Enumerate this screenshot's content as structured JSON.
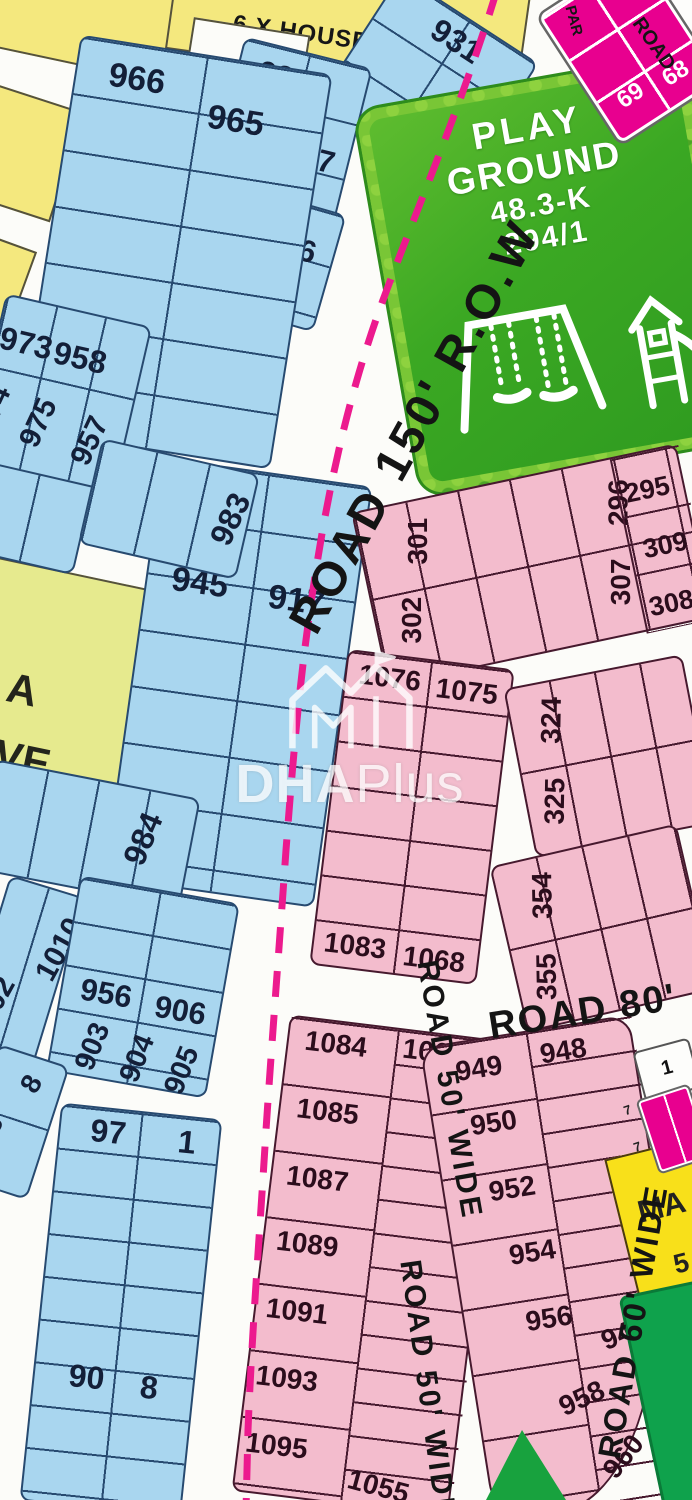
{
  "roads": {
    "row150": "ROAD 150' R.O.W",
    "r80": "ROAD 80'",
    "r50": "ROAD 50' WIDE",
    "r60": "ROAD 60' WIDE",
    "corner": "ROAD",
    "park": "PAR"
  },
  "areas": {
    "house": "6 X HOUSE",
    "pg1": "PLAY",
    "pg2": "GROUND",
    "pg3": "48.3-K",
    "pg4": "294/1",
    "res1": "A",
    "res2": "RVE",
    "ma": "MA",
    "ma5": "5"
  },
  "watermark": {
    "bold": "DHA",
    "light": "Plus"
  },
  "plots": {
    "blue_top": [
      "931",
      "932",
      "934",
      "927",
      "935",
      "926"
    ],
    "blue_left": [
      "966",
      "965"
    ],
    "blue_973": [
      "973",
      "958",
      "974",
      "975",
      "957"
    ],
    "blue_983": [
      "983"
    ],
    "blue_945": [
      "945",
      "917"
    ],
    "blue_984": [
      "984"
    ],
    "blue_1010": [
      "1010",
      "902"
    ],
    "blue_956": [
      "956",
      "906",
      "903",
      "904",
      "905"
    ],
    "blue_97": [
      "97",
      "1",
      "90",
      "8"
    ],
    "blue_98": [
      "8",
      "98"
    ],
    "pink_301": [
      "301",
      "302",
      "296",
      "307",
      "295",
      "309",
      "308"
    ],
    "pink_1076": [
      "1076",
      "1075",
      "1083",
      "1068"
    ],
    "pink_324": [
      "324",
      "325"
    ],
    "pink_354": [
      "354",
      "355"
    ],
    "pink_1084": [
      "1084",
      "1067",
      "1085",
      "1087",
      "1089",
      "1091",
      "1093",
      "1095",
      "1055"
    ],
    "pink_949": [
      "949",
      "948",
      "950",
      "952",
      "954",
      "956",
      "940",
      "958",
      "960"
    ],
    "magenta_69": [
      "69",
      "68"
    ],
    "magenta_edge": [
      "1",
      "7",
      "7"
    ]
  }
}
